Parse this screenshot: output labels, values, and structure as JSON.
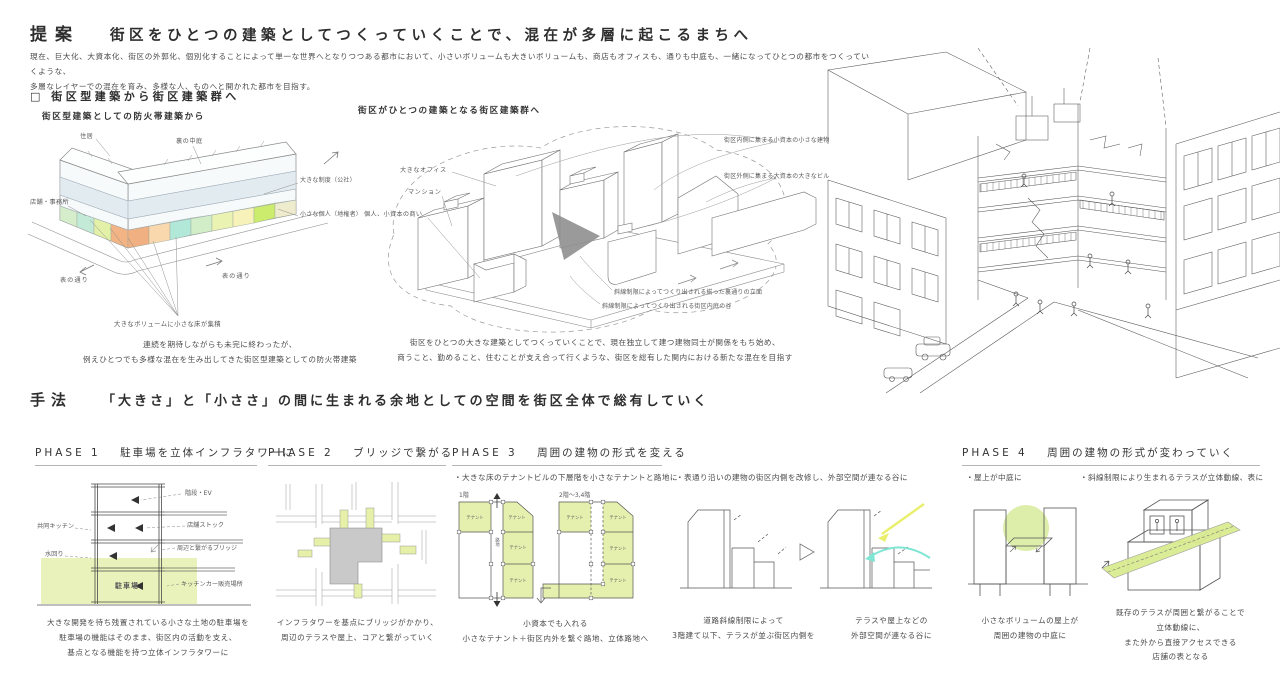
{
  "colors": {
    "parking_blue": "#3a49b4",
    "green_fill": "#e9f2ba",
    "gray_block": "#c9c9c9",
    "highlight_yellow": "#e9ef6b",
    "highlight_cyan": "#7fe6d4",
    "band_blue": "#dfe9ef",
    "floor_band_colors": [
      "#d5edcb",
      "#c3e9d7",
      "#e3f1a8",
      "#f2b484",
      "#f0b082",
      "#f8d8ac",
      "#b2e8d8",
      "#d2eec8",
      "#eaf3b2",
      "#f6f2ba",
      "#ccec6e",
      "#efeccd"
    ]
  },
  "proposal": {
    "label": "提案",
    "title": "街区をひとつの建築としてつくっていくことで、混在が多層に起こるまちへ",
    "body_1": "現在、巨大化、大資本化、街区の外郭化、個別化することによって単一な世界へとなりつつある都市において、小さいボリュームも大きいボリュームも、商店もオフィスも、通りも中庭も、一緒になってひとつの都市をつくっていくような、",
    "body_2": "多層なレイヤーでの混在を育み、多様な人、ものへと開かれた都市を目指す。",
    "subheading": "□ 街区型建築から街区建築群へ"
  },
  "before": {
    "title": "街区型建築としての防火帯建築から",
    "labels": {
      "residence": "住居",
      "courtyard": "裏の中庭",
      "shop_office": "店舗・事務所",
      "institution": "大きな制度（公社）",
      "individual": "小さな個人（地権者）",
      "street_left": "表の通り",
      "street_right": "表の通り",
      "accumulation": "大きなボリュームに小さな床が集積"
    },
    "caption_1": "連続を期待しながらも未完に終わったが、",
    "caption_2": "例えひとつでも多様な混在を生み出してきた街区型建築としての防火帯建築"
  },
  "after": {
    "title": "街区がひとつの建築となる街区建築群へ",
    "labels": {
      "office": "大きなオフィス",
      "mansion": "マンション",
      "small_business": "個人、小資本の商い",
      "inner": "街区内側に集まる小資本の小さな建物",
      "outer": "街区外側に集まる大資本の大きなビル",
      "facade": "斜線制限によってつくり出される揃った裏通りの立面",
      "valley": "斜線制限によってつくり出される街区内庭の谷"
    },
    "caption_1": "街区をひとつの大きな建築としてつくっていくことで、現在独立して建つ建物同士が関係をもち始め、",
    "caption_2": "商うこと、勤めること、住むことが支え合って行くような、街区を総有した関内における新たな混在を目指す"
  },
  "method": {
    "label": "手法",
    "title": "「大きさ」と「小ささ」の間に生まれる余地としての空間を街区全体で総有していく"
  },
  "phase1": {
    "number": "PHASE 1",
    "title": "駐車場を立体インフラタワーに",
    "labels": {
      "stairs_ev": "階段・EV",
      "kitchen": "共同キッチン",
      "stock": "店舗ストック",
      "water": "水回り",
      "bridge": "周辺と繋がるブリッジ",
      "parking": "駐車場",
      "kitchen_car": "キッチンカー販売場所"
    },
    "caption": [
      "大きな開発を待ち残置されている小さな土地の駐車場を",
      "駐車場の機能はそのまま、街区内の活動を支え、",
      "基点となる機能を持つ立体インフラタワーに"
    ]
  },
  "phase2": {
    "number": "PHASE 2",
    "title": "ブリッジで繋がる",
    "caption": [
      "インフラタワーを基点にブリッジがかかり、",
      "周辺のテラスや屋上、コアと繋がっていく"
    ]
  },
  "phase3": {
    "number": "PHASE 3",
    "title": "周囲の建物の形式を変える",
    "bullet_a": "・大きな床のテナントビルの下層階を小さなテナントと路地に",
    "plan1_label": "1階",
    "plan2_label": "2階〜3,4階",
    "tenant": "テナント",
    "alley": "路地",
    "caption_a": [
      "小資本でも入れる",
      "小さなテナント＋街区内外を繋ぐ路地、立体路地へ"
    ],
    "bullet_b": "・表通り沿いの建物の街区内側を改修し、外部空間が連なる谷に",
    "caption_b1": [
      "道路斜線制限によって",
      "3階建て以下、テラスが並ぶ街区内側を"
    ],
    "caption_b2": [
      "テラスや屋上などの",
      "外部空間が連なる谷に"
    ]
  },
  "phase4": {
    "number": "PHASE 4",
    "title": "周囲の建物の形式が変わっていく",
    "bullet_a": "・屋上が中庭に",
    "bullet_b": "・斜線制限により生まれるテラスが立体動線、表に",
    "caption_a": [
      "小さなボリュームの屋上が",
      "周囲の建物の中庭に"
    ],
    "caption_b": [
      "既存のテラスが周囲と繋がることで",
      "立体動線に、",
      "また外から直接アクセスできる",
      "店舗の表となる"
    ]
  }
}
